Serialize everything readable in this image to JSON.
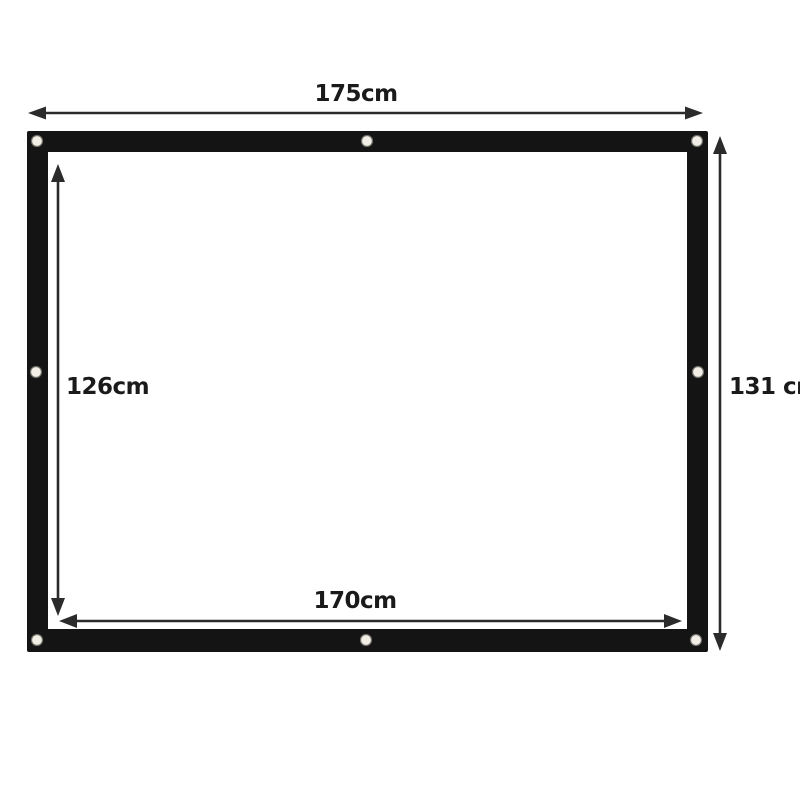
{
  "diagram": {
    "type": "product-dimension-diagram",
    "subject": "projection screen with grommet eyelets",
    "labels": {
      "outer_width": "175cm",
      "outer_height": "131 cm",
      "inner_height": "126cm",
      "inner_width": "170cm"
    },
    "measurements": {
      "outer_width_cm": 175,
      "outer_height_cm": 131,
      "inner_width_cm": 170,
      "inner_height_cm": 126
    },
    "grommets": {
      "count": 8,
      "positions": [
        "top-left",
        "top-center",
        "top-right",
        "middle-left",
        "middle-right",
        "bottom-left",
        "bottom-center",
        "bottom-right"
      ]
    },
    "colors": {
      "background": "#ffffff",
      "frame": "#141414",
      "screen": "#ffffff",
      "arrow": "#2b2b2b",
      "grommet": "#f2eee5",
      "text": "#1a1a1a"
    }
  }
}
